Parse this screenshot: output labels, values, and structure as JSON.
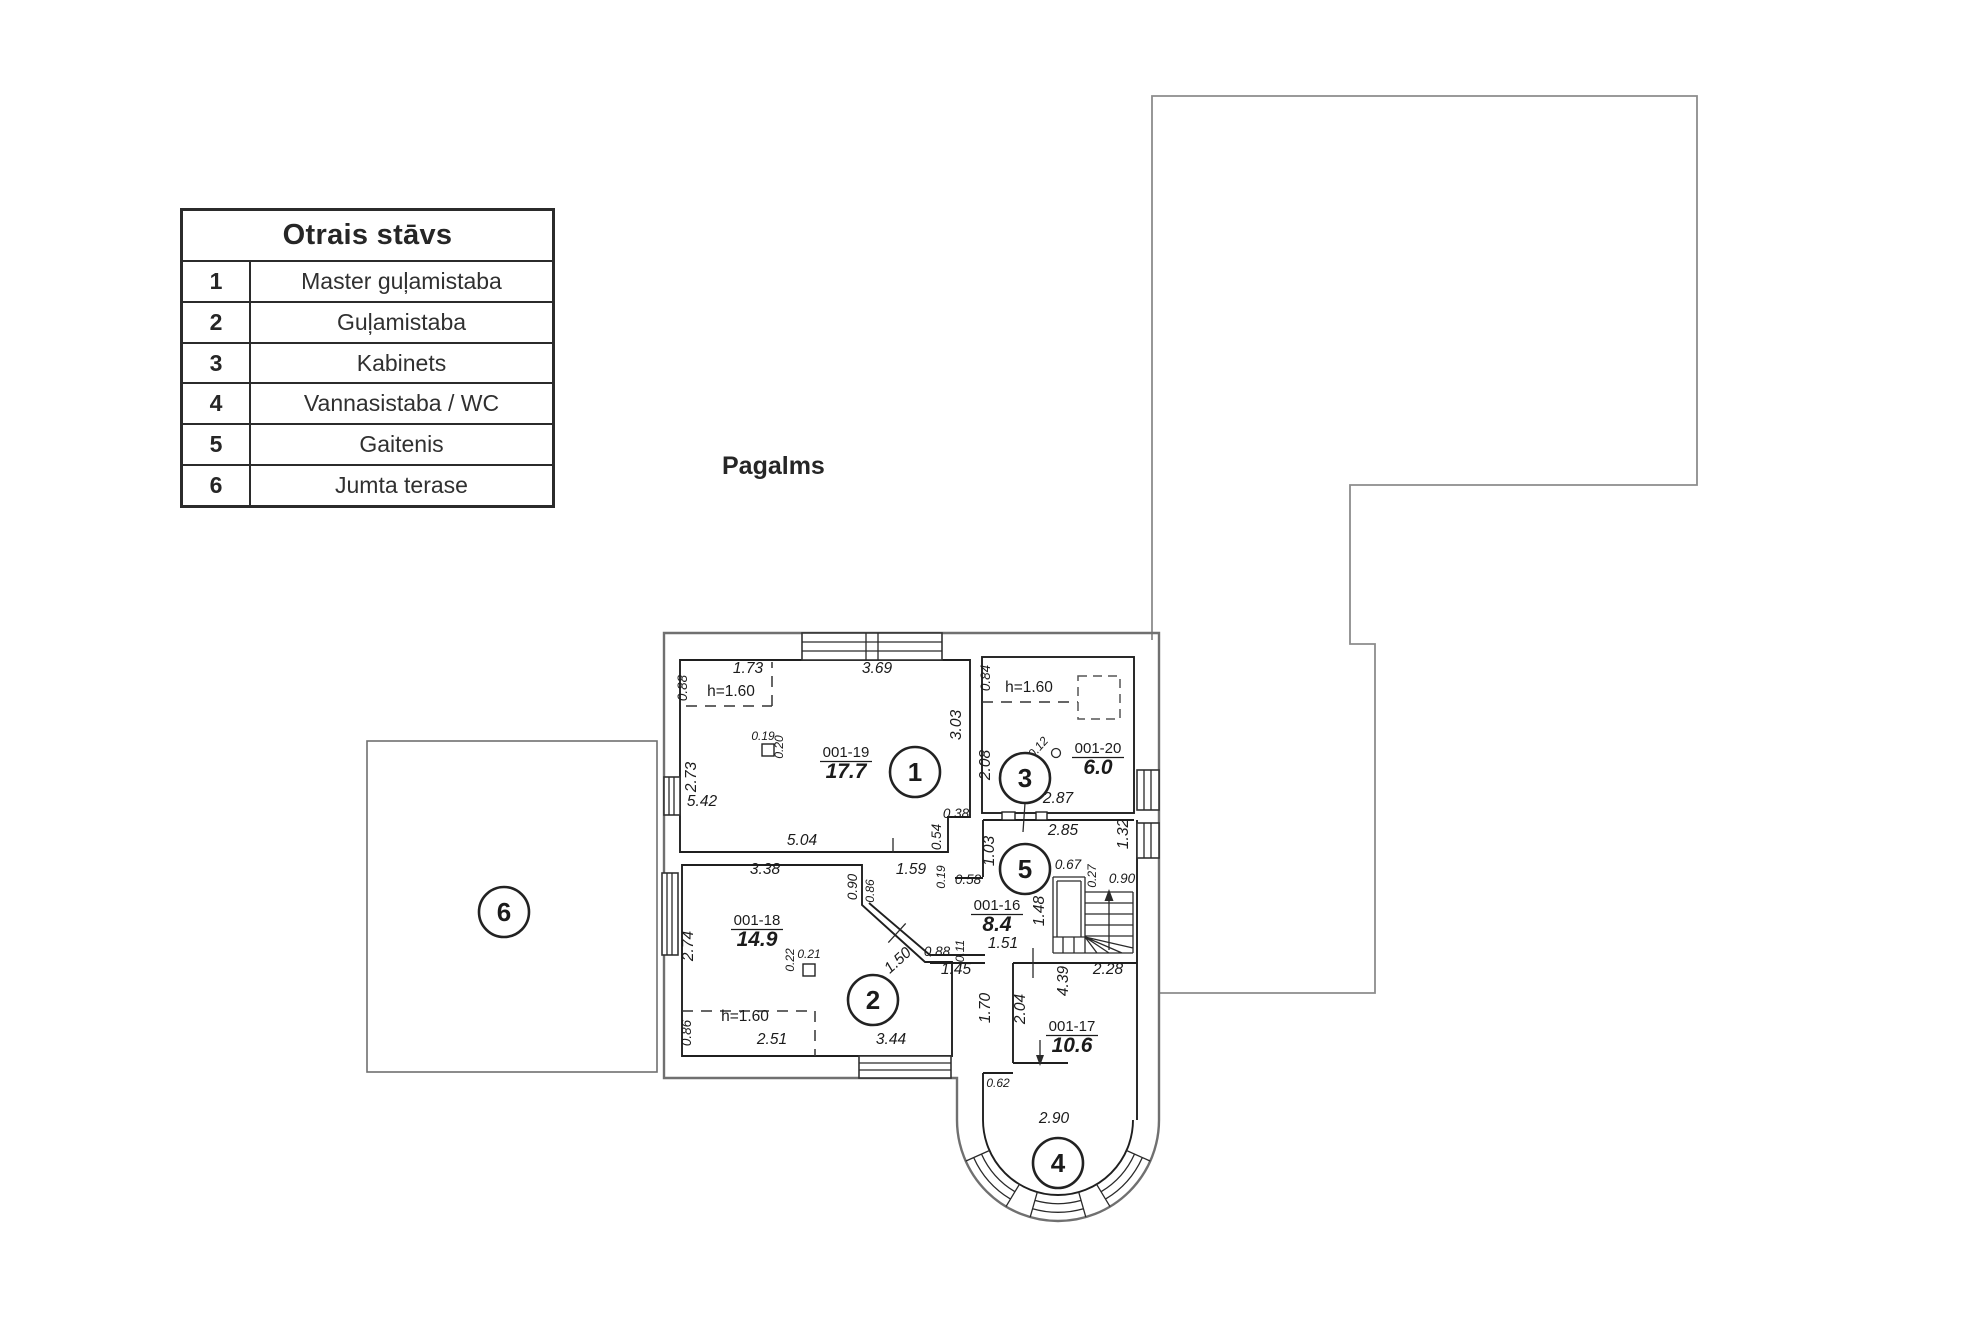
{
  "legend": {
    "title": "Otrais stāvs",
    "rows": [
      {
        "num": "1",
        "label": "Master guļamistaba"
      },
      {
        "num": "2",
        "label": "Guļamistaba"
      },
      {
        "num": "3",
        "label": "Kabinets"
      },
      {
        "num": "4",
        "label": "Vannasistaba / WC"
      },
      {
        "num": "5",
        "label": "Gaitenis"
      },
      {
        "num": "6",
        "label": "Jumta terase"
      }
    ]
  },
  "yard_label": "Pagalms",
  "plan": {
    "room_tags": [
      {
        "code": "001-19",
        "area": "17.7",
        "x": 846,
        "y": 757
      },
      {
        "code": "001-20",
        "area": "6.0",
        "x": 1098,
        "y": 753
      },
      {
        "code": "001-16",
        "area": "8.4",
        "x": 997,
        "y": 910
      },
      {
        "code": "001-18",
        "area": "14.9",
        "x": 757,
        "y": 925
      },
      {
        "code": "001-17",
        "area": "10.6",
        "x": 1072,
        "y": 1031
      }
    ],
    "room_circles": [
      {
        "n": "1",
        "x": 915,
        "y": 772
      },
      {
        "n": "2",
        "x": 873,
        "y": 1000
      },
      {
        "n": "3",
        "x": 1025,
        "y": 778
      },
      {
        "n": "4",
        "x": 1058,
        "y": 1163
      },
      {
        "n": "5",
        "x": 1025,
        "y": 869
      },
      {
        "n": "6",
        "x": 504,
        "y": 912
      }
    ],
    "labels": [
      {
        "t": "1.73",
        "x": 748,
        "y": 673,
        "c": "d"
      },
      {
        "t": "0.88",
        "x": 687,
        "y": 688,
        "r": -90,
        "c": "m"
      },
      {
        "t": "h=1.60",
        "x": 731,
        "y": 696,
        "c": "p"
      },
      {
        "t": "3.69",
        "x": 877,
        "y": 673,
        "c": "d"
      },
      {
        "t": "3.03",
        "x": 961,
        "y": 725,
        "r": -90,
        "c": "d"
      },
      {
        "t": "0.19",
        "x": 763,
        "y": 740,
        "c": "s"
      },
      {
        "t": "0.20",
        "x": 783,
        "y": 747,
        "r": -90,
        "c": "s"
      },
      {
        "t": "2.73",
        "x": 696,
        "y": 777,
        "r": -90,
        "c": "d"
      },
      {
        "t": "5.42",
        "x": 702,
        "y": 806,
        "c": "d"
      },
      {
        "t": "5.04",
        "x": 802,
        "y": 845,
        "c": "d"
      },
      {
        "t": "0.38",
        "x": 956,
        "y": 818,
        "c": "m"
      },
      {
        "t": "0.54",
        "x": 941,
        "y": 837,
        "r": -90,
        "c": "m"
      },
      {
        "t": "0.84",
        "x": 990,
        "y": 678,
        "r": -90,
        "c": "m"
      },
      {
        "t": "h=1.60",
        "x": 1029,
        "y": 692,
        "c": "p"
      },
      {
        "t": "0.12",
        "x": 1041,
        "y": 750,
        "r": -48,
        "c": "s"
      },
      {
        "t": "2.08",
        "x": 990,
        "y": 765,
        "r": -90,
        "c": "d"
      },
      {
        "t": "2.87",
        "x": 1058,
        "y": 803,
        "c": "d"
      },
      {
        "t": "2.85",
        "x": 1063,
        "y": 835,
        "c": "d"
      },
      {
        "t": "1.32",
        "x": 1128,
        "y": 834,
        "r": -90,
        "c": "d"
      },
      {
        "t": "1.03",
        "x": 994,
        "y": 851,
        "r": -90,
        "c": "d"
      },
      {
        "t": "0.58",
        "x": 968,
        "y": 884,
        "c": "m"
      },
      {
        "t": "0.67",
        "x": 1068,
        "y": 869,
        "c": "m"
      },
      {
        "t": "0.27",
        "x": 1096,
        "y": 876,
        "r": -90,
        "c": "s"
      },
      {
        "t": "0.90",
        "x": 1122,
        "y": 883,
        "c": "m"
      },
      {
        "t": "1.48",
        "x": 1044,
        "y": 911,
        "r": -90,
        "c": "d"
      },
      {
        "t": "1.51",
        "x": 1003,
        "y": 948,
        "c": "d"
      },
      {
        "t": "0.11",
        "x": 964,
        "y": 951,
        "r": -90,
        "c": "s"
      },
      {
        "t": "1.59",
        "x": 911,
        "y": 874,
        "c": "d"
      },
      {
        "t": "0.19",
        "x": 945,
        "y": 877,
        "r": -90,
        "c": "s"
      },
      {
        "t": "3.38",
        "x": 765,
        "y": 874,
        "c": "d"
      },
      {
        "t": "0.90",
        "x": 857,
        "y": 887,
        "r": -90,
        "c": "m"
      },
      {
        "t": "0.86",
        "x": 874,
        "y": 891,
        "r": -90,
        "c": "s"
      },
      {
        "t": "2.74",
        "x": 693,
        "y": 946,
        "r": -90,
        "c": "d"
      },
      {
        "t": "0.22",
        "x": 794,
        "y": 960,
        "r": -90,
        "c": "s"
      },
      {
        "t": "0.21",
        "x": 809,
        "y": 958,
        "c": "s"
      },
      {
        "t": "1.50",
        "x": 901,
        "y": 964,
        "r": -42,
        "c": "d"
      },
      {
        "t": "0.88",
        "x": 937,
        "y": 956,
        "c": "m"
      },
      {
        "t": "1.45",
        "x": 956,
        "y": 974,
        "c": "d"
      },
      {
        "t": "h=1.60",
        "x": 745,
        "y": 1021,
        "c": "p"
      },
      {
        "t": "0.86",
        "x": 691,
        "y": 1033,
        "r": -90,
        "c": "m"
      },
      {
        "t": "2.51",
        "x": 772,
        "y": 1044,
        "c": "d"
      },
      {
        "t": "3.44",
        "x": 891,
        "y": 1044,
        "c": "d"
      },
      {
        "t": "1.70",
        "x": 990,
        "y": 1008,
        "r": -90,
        "c": "d"
      },
      {
        "t": "2.04",
        "x": 1025,
        "y": 1009,
        "r": -90,
        "c": "d"
      },
      {
        "t": "4.39",
        "x": 1068,
        "y": 981,
        "r": -90,
        "c": "d"
      },
      {
        "t": "2.28",
        "x": 1108,
        "y": 974,
        "c": "d"
      },
      {
        "t": "0.62",
        "x": 998,
        "y": 1087,
        "c": "s"
      },
      {
        "t": "2.90",
        "x": 1054,
        "y": 1123,
        "c": "d"
      }
    ]
  }
}
